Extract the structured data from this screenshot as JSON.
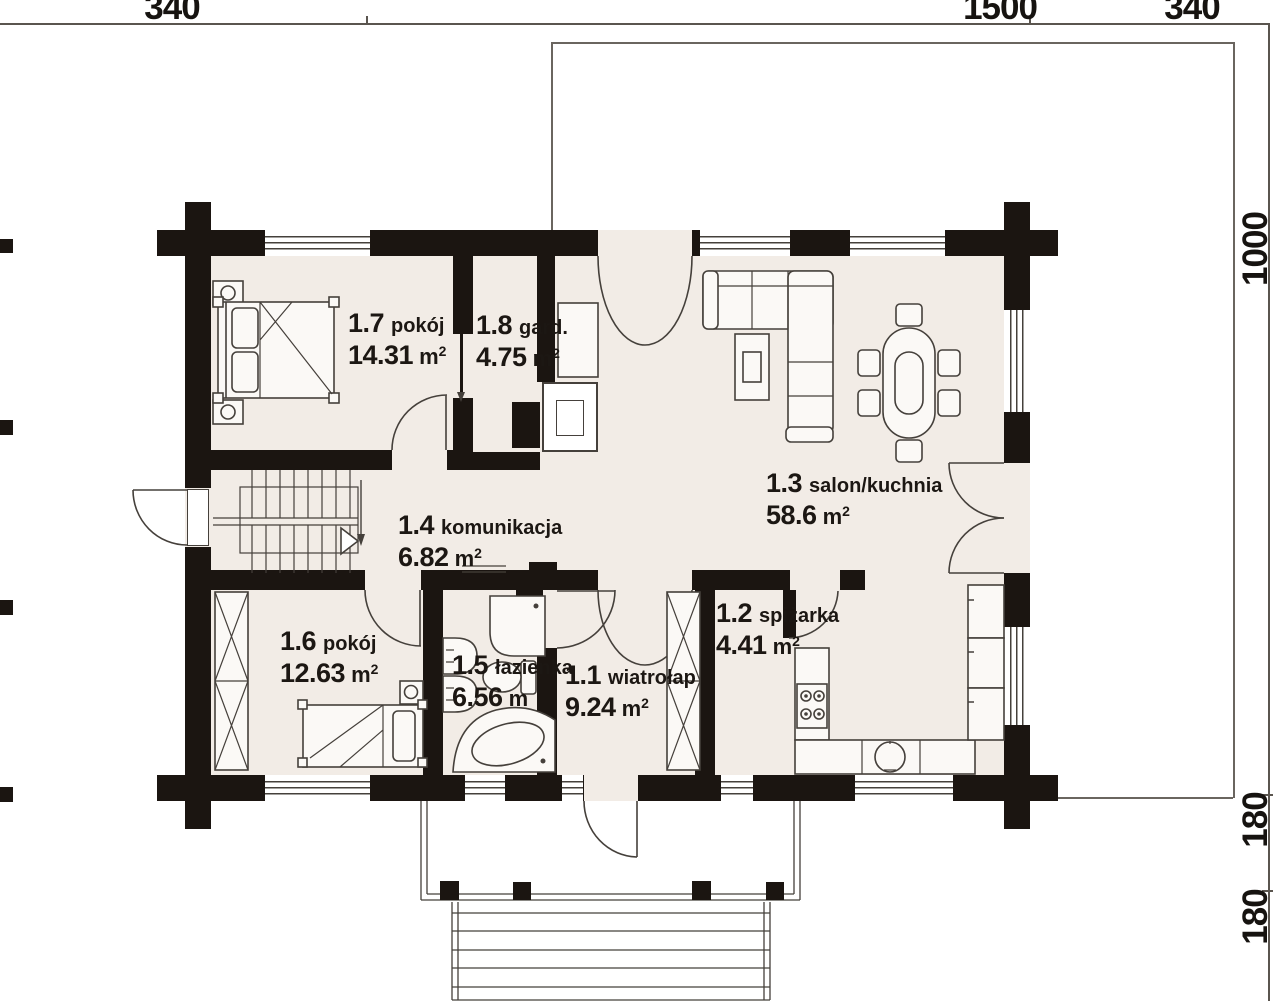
{
  "dimensions": {
    "top": [
      "340",
      "1500",
      "340"
    ],
    "right": [
      "1000",
      "180",
      "180"
    ]
  },
  "rooms": [
    {
      "id": "1.7",
      "name": "pokój",
      "area": "14.31",
      "unit": "m",
      "sup": "2"
    },
    {
      "id": "1.8",
      "name": "gard.",
      "area": "4.75",
      "unit": "m",
      "sup": "2"
    },
    {
      "id": "1.4",
      "name": "komunikacja",
      "area": "6.82",
      "unit": "m",
      "sup": "2"
    },
    {
      "id": "1.3",
      "name": "salon/kuchnia",
      "area": "58.6",
      "unit": "m",
      "sup": "2"
    },
    {
      "id": "1.6",
      "name": "pokój",
      "area": "12.63",
      "unit": "m",
      "sup": "2"
    },
    {
      "id": "1.5",
      "name": "łazienka",
      "area": "6.56",
      "unit": "m",
      "sup": ""
    },
    {
      "id": "1.1",
      "name": "wiatrołap",
      "area": "9.24",
      "unit": "m",
      "sup": "2"
    },
    {
      "id": "1.2",
      "name": "spiżarka",
      "area": "4.41",
      "unit": "m",
      "sup": "2"
    }
  ],
  "colors": {
    "wall": "#1b1511",
    "floor": "#f2ece6",
    "line": "#45403b"
  }
}
